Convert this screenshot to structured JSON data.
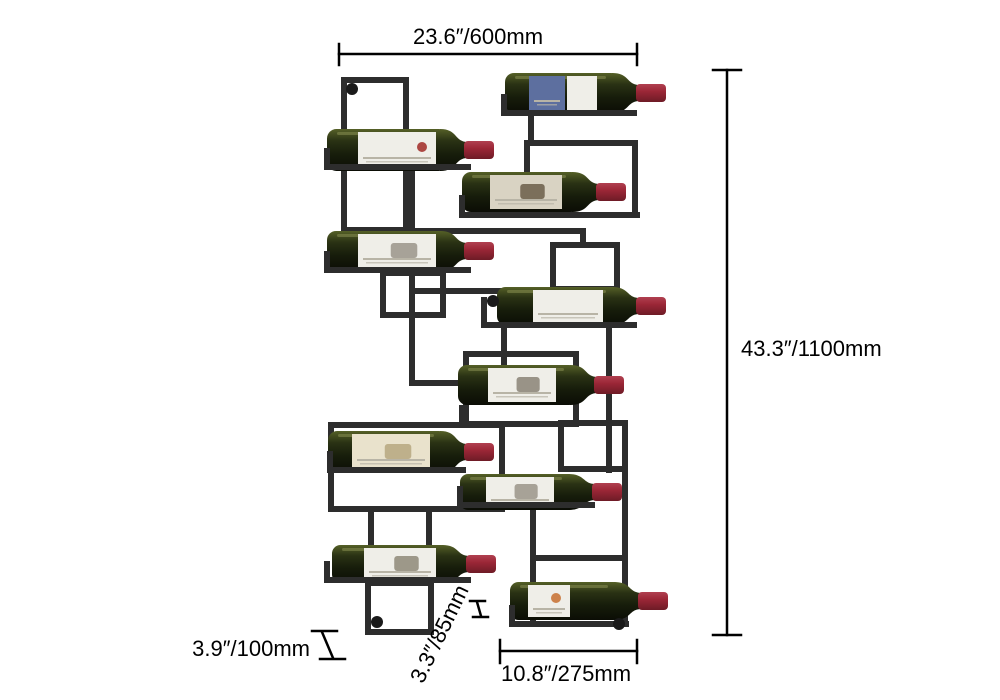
{
  "diagram": {
    "product": "Wall-mounted metal wine rack holding wine bottles",
    "bottle_count": 10,
    "annotations": {
      "width": "23.6″/600mm",
      "height": "43.3″/1100mm",
      "depth": "3.9″/100mm",
      "rack_depth": "3.3″/85mm",
      "bottom_width": "10.8″/275mm"
    }
  },
  "colors": {
    "background": "#ffffff",
    "dimension": "#000000",
    "frame": "#2d2d2d",
    "mount_dot": "#1a1a1a",
    "glass_highlight": "#556027",
    "glass_mid": "#2a3214",
    "glass_dark": "#0b0d05",
    "glass_glint": "#8d9456",
    "cork_light": "#b04050",
    "cork": "#9c2737",
    "cork_dark": "#6e1b26",
    "label_white": "#efeee8",
    "label_blue": "#5d6f9f",
    "label_cream": "#e9e2cc",
    "label_beige": "#d9d3c3",
    "label_line": "#b8b4a6"
  }
}
